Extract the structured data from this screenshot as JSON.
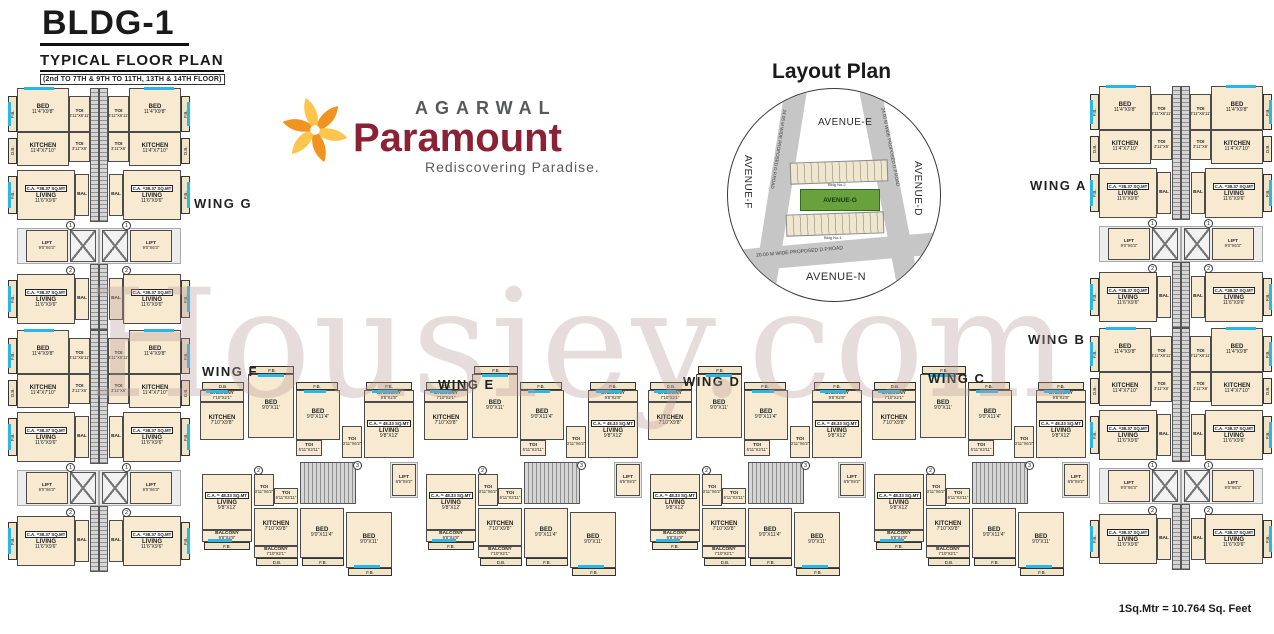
{
  "header": {
    "building": "BLDG-1",
    "plan_title": "TYPICAL FLOOR PLAN",
    "floors_note": "(2nd TO 7TH & 9TH TO 11TH, 13TH & 14TH FLOOR)"
  },
  "brand": {
    "name": "AGARWAL",
    "product": "Paramount",
    "tagline": "Rediscovering Paradise.",
    "colors": {
      "swirl_orange": "#f0941f",
      "swirl_yellow": "#fdc54c",
      "maroon": "#8a2135",
      "gray": "#58595b"
    }
  },
  "layout_plan": {
    "title": "Layout Plan",
    "avenue_top": "AVENUE-E",
    "avenue_left": "AVENUE-F",
    "avenue_right": "AVENUE-D",
    "avenue_bottom": "AVENUE-N",
    "road_left": "24.05 M WIDE PROPOSED D.P.ROAD",
    "road_right": "24.00 M WIDE PROPOSED D.P.ROAD",
    "road_bottom": "20.00 M WIDE PROPOSED D.P.ROAD",
    "site_label": "AVENUE-G",
    "building_labels": [
      "Bldg No.2",
      "Bldg No.1"
    ]
  },
  "watermark": "Housiey.com",
  "footer": {
    "scale_note": "1Sq.Mtr = 10.764 Sq. Feet"
  },
  "wings": [
    {
      "label": "WING G",
      "x": 194,
      "y": 196
    },
    {
      "label": "WING A",
      "x": 1030,
      "y": 178
    },
    {
      "label": "WING B",
      "x": 1028,
      "y": 332
    },
    {
      "label": "WING C",
      "x": 928,
      "y": 371
    },
    {
      "label": "WING D",
      "x": 683,
      "y": 374
    },
    {
      "label": "WING E",
      "x": 438,
      "y": 377
    },
    {
      "label": "WING F",
      "x": 202,
      "y": 364
    }
  ],
  "room_inventory": {
    "bed_dims": [
      "11'4\"X9'8\"",
      "9'0\"X11'",
      "9'0\"X11'4\"",
      "11'X9'",
      "11'X9'2\"",
      "10'3\"X11'4\"",
      "9'2\"X11'",
      "11'4\"X9'",
      "11'4\"X10'0\""
    ],
    "kitchen_dims": [
      "11'4\"X7'10\"",
      "7'10\"X9'8\"",
      "8'2\"X7'10\"",
      "10'X7'10\"",
      "7'9\"X7'10\""
    ],
    "living_dims": [
      "11'6\"X9'6\"",
      "9'8\"X12'",
      "9'8\"X11'10\"",
      "11'2\"X9'6\"",
      "10'10\"X9'6\"",
      "16'3\"X13'11\""
    ],
    "toi_dims": [
      "3'11\"X6'11\"",
      "3'11\"X6'",
      "3'11\"X6'2\"",
      "6'11\"X3'11\"",
      "3'11\"X6'1\""
    ],
    "lift_dims": [
      "9'0\"X6'3\"",
      "6'3\"X9'0\"",
      "6'5\"X9'2\"",
      "6'7\"X6'10\"",
      "6'3\"X6'3\""
    ],
    "carpet_areas": [
      "C.A. =38.37 SQ.MT",
      "C.A. = 48.33 SQ.MT",
      "C.A. = 46.57 SQ.MT",
      "C.A. = 33.71 SQ.MT",
      "C.A. = 63.03 SQ.MT",
      "C.A. = 73.23 SQ.MT"
    ]
  },
  "plan": {
    "templates": {
      "vunit": {
        "w": 91,
        "h": 242,
        "boxes": [
          {
            "t": "strip",
            "x": 0,
            "y": 8,
            "w": 9,
            "h": 36,
            "tx": "F.B.",
            "v": 1
          },
          {
            "t": "strip",
            "x": 0,
            "y": 50,
            "w": 9,
            "h": 26,
            "tx": "D.B.",
            "v": 1
          },
          {
            "t": "strip",
            "x": 0,
            "y": 88,
            "w": 9,
            "h": 38,
            "tx": "F.B.",
            "v": 1
          },
          {
            "t": "strip",
            "x": 0,
            "y": 192,
            "w": 9,
            "h": 38,
            "tx": "F.B.",
            "v": 1
          },
          {
            "t": "room",
            "x": 9,
            "y": 0,
            "w": 52,
            "h": 44,
            "l": "BED",
            "d": "11'4\"X9'8\""
          },
          {
            "t": "room",
            "x": 61,
            "y": 8,
            "w": 21,
            "h": 36,
            "l": "TOI",
            "d": "3'11\"X6'11\"",
            "small": 1
          },
          {
            "t": "room",
            "x": 9,
            "y": 44,
            "w": 52,
            "h": 34,
            "l": "KITCHEN",
            "d": "11'4\"X7'10\""
          },
          {
            "t": "room",
            "x": 61,
            "y": 44,
            "w": 21,
            "h": 30,
            "l": "TOI",
            "d": "3'11\"X6'",
            "small": 1
          },
          {
            "t": "core",
            "x": 82,
            "y": 0,
            "w": 9,
            "h": 134,
            "cls": "stairh"
          },
          {
            "t": "room",
            "x": 9,
            "y": 82,
            "w": 58,
            "h": 50,
            "l": "LIVING",
            "d": "11'6\"X9'6\"",
            "ca": "C.A. =38.37 SQ.MT"
          },
          {
            "t": "room",
            "x": 67,
            "y": 86,
            "w": 14,
            "h": 42,
            "l": "BAL",
            "small": 1
          },
          {
            "t": "core",
            "x": 9,
            "y": 140,
            "w": 82,
            "h": 36,
            "cls": "plain"
          },
          {
            "t": "room",
            "x": 18,
            "y": 142,
            "w": 42,
            "h": 32,
            "l": "LIFT",
            "d": "9'0\"X6'3\"",
            "small": 1
          },
          {
            "t": "core",
            "x": 62,
            "y": 142,
            "w": 26,
            "h": 32,
            "cls": "xbox"
          },
          {
            "t": "circ",
            "x": 58,
            "y": 133,
            "tx": "1"
          },
          {
            "t": "circ",
            "x": 58,
            "y": 178,
            "tx": "2"
          },
          {
            "t": "room",
            "x": 9,
            "y": 186,
            "w": 58,
            "h": 50,
            "l": "LIVING",
            "d": "11'6\"X9'6\"",
            "ca": "C.A. =38.37 SQ.MT"
          },
          {
            "t": "room",
            "x": 67,
            "y": 190,
            "w": 14,
            "h": 42,
            "l": "BAL",
            "small": 1
          },
          {
            "t": "core",
            "x": 82,
            "y": 176,
            "w": 9,
            "h": 66,
            "cls": "stairh"
          },
          {
            "t": "win",
            "x": 16,
            "y": -1,
            "w": 30,
            "h": 3
          },
          {
            "t": "win",
            "x": 0,
            "y": 14,
            "w": 3,
            "h": 24
          },
          {
            "t": "win",
            "x": 0,
            "y": 94,
            "w": 3,
            "h": 26
          },
          {
            "t": "win",
            "x": 0,
            "y": 198,
            "w": 3,
            "h": 26
          }
        ]
      },
      "hmod": {
        "w": 224,
        "h": 210,
        "boxes": [
          {
            "t": "strip",
            "x": 54,
            "y": 0,
            "w": 44,
            "h": 8,
            "tx": "F.B."
          },
          {
            "t": "room",
            "x": 52,
            "y": 8,
            "w": 46,
            "h": 64,
            "l": "BED",
            "d": "9'0\"X11'"
          },
          {
            "t": "win",
            "x": 62,
            "y": 8,
            "w": 26,
            "h": 3
          },
          {
            "t": "strip",
            "x": 6,
            "y": 16,
            "w": 42,
            "h": 8,
            "tx": "D.B."
          },
          {
            "t": "room",
            "x": 4,
            "y": 24,
            "w": 44,
            "h": 12,
            "l": "BALCONY",
            "d": "7'10\"X2'1\"",
            "small": 1
          },
          {
            "t": "room",
            "x": 4,
            "y": 36,
            "w": 44,
            "h": 38,
            "l": "KITCHEN",
            "d": "7'10\"X9'8\""
          },
          {
            "t": "win",
            "x": 10,
            "y": 24,
            "w": 22,
            "h": 3
          },
          {
            "t": "strip",
            "x": 100,
            "y": 16,
            "w": 42,
            "h": 8,
            "tx": "F.B."
          },
          {
            "t": "room",
            "x": 100,
            "y": 24,
            "w": 44,
            "h": 50,
            "l": "BED",
            "d": "9'0\"X11'4\""
          },
          {
            "t": "win",
            "x": 108,
            "y": 24,
            "w": 22,
            "h": 3
          },
          {
            "t": "room",
            "x": 100,
            "y": 74,
            "w": 26,
            "h": 16,
            "l": "TOI",
            "d": "6'11\"X3'11\"",
            "small": 1
          },
          {
            "t": "room",
            "x": 146,
            "y": 60,
            "w": 20,
            "h": 32,
            "l": "TOI",
            "d": "3'11\"X6'2\"",
            "small": 1
          },
          {
            "t": "strip",
            "x": 170,
            "y": 16,
            "w": 46,
            "h": 8,
            "tx": "F.B."
          },
          {
            "t": "room",
            "x": 168,
            "y": 24,
            "w": 50,
            "h": 12,
            "l": "BALCONY",
            "d": "9'8\"X2'8\"",
            "small": 1
          },
          {
            "t": "room",
            "x": 168,
            "y": 36,
            "w": 50,
            "h": 56,
            "l": "LIVING",
            "d": "9'8\"X12'",
            "ca": "C.A. = 48.33 SQ.MT"
          },
          {
            "t": "win",
            "x": 176,
            "y": 24,
            "w": 26,
            "h": 3
          },
          {
            "t": "circ",
            "x": 157,
            "y": 95,
            "tx": "3"
          },
          {
            "t": "core",
            "x": 104,
            "y": 96,
            "w": 56,
            "h": 42,
            "cls": "stairv"
          },
          {
            "t": "core",
            "x": 194,
            "y": 96,
            "w": 28,
            "h": 36,
            "cls": "plain"
          },
          {
            "t": "room",
            "x": 196,
            "y": 98,
            "w": 24,
            "h": 32,
            "l": "LIFT",
            "d": "6'5\"X9'2\"",
            "small": 1
          },
          {
            "t": "circ",
            "x": 58,
            "y": 100,
            "tx": "2"
          },
          {
            "t": "room",
            "x": 6,
            "y": 108,
            "w": 50,
            "h": 56,
            "l": "LIVING",
            "d": "9'8\"X12'",
            "ca": "C.A. = 48.33 SQ.MT"
          },
          {
            "t": "room",
            "x": 6,
            "y": 164,
            "w": 50,
            "h": 12,
            "l": "BALCONY",
            "d": "9'8\"X2'8\"",
            "small": 1
          },
          {
            "t": "strip",
            "x": 8,
            "y": 176,
            "w": 46,
            "h": 8,
            "tx": "F.B."
          },
          {
            "t": "room",
            "x": 58,
            "y": 108,
            "w": 20,
            "h": 32,
            "l": "TOI",
            "d": "3'11\"X6'2\"",
            "small": 1
          },
          {
            "t": "room",
            "x": 78,
            "y": 122,
            "w": 24,
            "h": 16,
            "l": "TOI",
            "d": "6'11\"X3'11\"",
            "small": 1
          },
          {
            "t": "room",
            "x": 58,
            "y": 142,
            "w": 44,
            "h": 38,
            "l": "KITCHEN",
            "d": "7'10\"X9'8\""
          },
          {
            "t": "room",
            "x": 58,
            "y": 180,
            "w": 44,
            "h": 12,
            "l": "BALCONY",
            "d": "7'10\"X2'1\"",
            "small": 1
          },
          {
            "t": "strip",
            "x": 60,
            "y": 192,
            "w": 42,
            "h": 8,
            "tx": "D.B."
          },
          {
            "t": "room",
            "x": 104,
            "y": 142,
            "w": 44,
            "h": 50,
            "l": "BED",
            "d": "9'0\"X11'4\""
          },
          {
            "t": "strip",
            "x": 106,
            "y": 192,
            "w": 42,
            "h": 8,
            "tx": "F.B."
          },
          {
            "t": "room",
            "x": 150,
            "y": 146,
            "w": 46,
            "h": 56,
            "l": "BED",
            "d": "9'0\"X11'"
          },
          {
            "t": "strip",
            "x": 152,
            "y": 202,
            "w": 44,
            "h": 8,
            "tx": "F.B."
          },
          {
            "t": "win",
            "x": 158,
            "y": 199,
            "w": 26,
            "h": 3
          },
          {
            "t": "win",
            "x": 12,
            "y": 173,
            "w": 24,
            "h": 3
          }
        ]
      }
    },
    "instances": [
      {
        "tpl": "vunit",
        "x": 8,
        "y": 88
      },
      {
        "tpl": "vunit",
        "x": 99,
        "y": 88,
        "flip": true
      },
      {
        "tpl": "vunit",
        "x": 8,
        "y": 330
      },
      {
        "tpl": "vunit",
        "x": 99,
        "y": 330,
        "flip": true
      },
      {
        "tpl": "vunit",
        "x": 1090,
        "y": 86
      },
      {
        "tpl": "vunit",
        "x": 1181,
        "y": 86,
        "flip": true
      },
      {
        "tpl": "vunit",
        "x": 1090,
        "y": 328
      },
      {
        "tpl": "vunit",
        "x": 1181,
        "y": 328,
        "flip": true
      },
      {
        "tpl": "hmod",
        "x": 196,
        "y": 366
      },
      {
        "tpl": "hmod",
        "x": 420,
        "y": 366
      },
      {
        "tpl": "hmod",
        "x": 644,
        "y": 366
      },
      {
        "tpl": "hmod",
        "x": 868,
        "y": 366
      }
    ]
  }
}
